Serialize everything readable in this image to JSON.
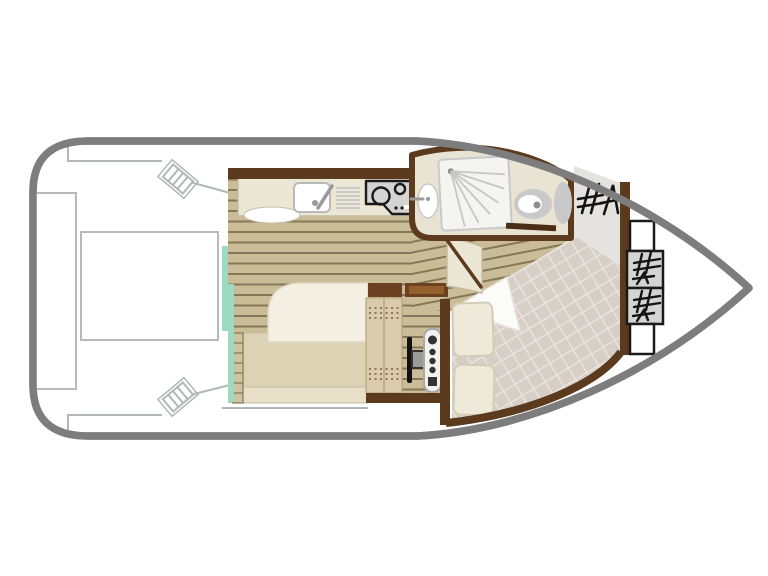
{
  "diagram": {
    "kind": "boat-floor-plan",
    "orientation": "bow-right",
    "rooms": [
      {
        "name": "aft-deck",
        "fixtures": [
          "bench-seat",
          "deck-table",
          "boarding-step-port",
          "boarding-step-starboard"
        ]
      },
      {
        "name": "galley",
        "fixtures": [
          "sink",
          "faucet",
          "drainboard",
          "two-burner-stove"
        ]
      },
      {
        "name": "salon",
        "fixtures": [
          "convertible-berth",
          "side-shelf",
          "sliding-glass-door"
        ]
      },
      {
        "name": "helm-station",
        "fixtures": [
          "helm-bench",
          "steering-wheel",
          "instrument-console",
          "storage-cabinet"
        ]
      },
      {
        "name": "bathroom",
        "fixtures": [
          "washbasin",
          "shower",
          "toilet",
          "cistern",
          "door"
        ]
      },
      {
        "name": "locker",
        "fixtures": [
          "hatch-glyph"
        ]
      },
      {
        "name": "bow-cabin",
        "fixtures": [
          "double-berth-quilt",
          "turned-sheet-fold",
          "pillow",
          "pillow",
          "cabin-door"
        ]
      },
      {
        "name": "bow-deck",
        "fixtures": [
          "locker-box",
          "hash-locker",
          "hash-locker",
          "locker-box"
        ]
      }
    ]
  },
  "colors": {
    "background": "#ffffff",
    "hull_outline": "#7d7d7d",
    "deck_line": "#b3b6b7",
    "furniture_outline": "#b9b9b9",
    "wall": "#5c3a1e",
    "wall_dark": "#4a2d15",
    "wood": "#cabc96",
    "wood_line": "#857757",
    "counter": "#ece6d4",
    "counter_edge": "#c5bda4",
    "sliding_door_glass": "#9ed9c2",
    "steel": "#d4d4d4",
    "outline_dark": "#1a1a1a",
    "bathroom_floor": "#e9e3d3",
    "fixture_gray": "#c9c9c9",
    "fixture_dot": "#8e8e8e",
    "shower_white": "#f4f4f1",
    "spray": "#c6c6c6",
    "locker_gray": "#e4e3e0",
    "glyph": "#141414",
    "quilt": "#d7cfc7",
    "quilt_line": "#e9e3dd",
    "fold_white": "#fbfbf9",
    "pillow": "#eee9d8",
    "pillow_edge": "#d2ccb6",
    "mattress": "#f3efe2",
    "mattress_edge": "#e0dac6",
    "cushion": "#dcd2b4",
    "cushion_foot": "#e7dfc8",
    "shelf": "#cfc2a0",
    "bench": "#d9cbab",
    "bench_line": "#b5a782",
    "bench_dot": "#8a7a58",
    "cabinet": "#6b4122",
    "cabinet_light": "#955f2d",
    "console": "#f1f1ee",
    "console_edge": "#a8a8a8",
    "console_knob": "#333333",
    "wheel": "#111111",
    "wheel_hub": "#9a9a9a",
    "white": "#ffffff"
  }
}
